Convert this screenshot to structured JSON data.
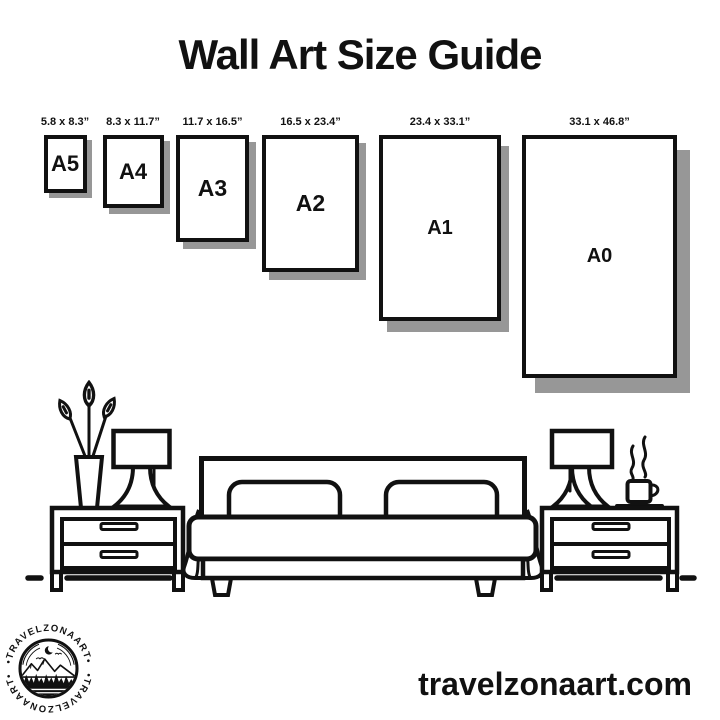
{
  "title": "Wall Art Size Guide",
  "sizes": [
    {
      "name": "A5",
      "dimensions": "5.8 x 8.3”"
    },
    {
      "name": "A4",
      "dimensions": "8.3 x 11.7”"
    },
    {
      "name": "A3",
      "dimensions": "11.7 x 16.5”"
    },
    {
      "name": "A2",
      "dimensions": "16.5 x 23.4”"
    },
    {
      "name": "A1",
      "dimensions": "23.4 x 33.1”"
    },
    {
      "name": "A0",
      "dimensions": "33.1 x 46.8”"
    }
  ],
  "illustration": {
    "icons": [
      "flower-vase-icon",
      "table-lamp-icon",
      "nightstand-icon",
      "double-bed-icon",
      "pillow-icon",
      "coffee-cup-icon",
      "steam-icon",
      "floor-line"
    ]
  },
  "logo": {
    "arc_text_top": "•TRAVELZONAART•",
    "arc_text_bottom": "•TRAVELZONAART•",
    "scene_icons": [
      "crescent-moon-icon",
      "rainbow-arc-icon",
      "birds-icon",
      "mountains-icon",
      "pine-trees-icon",
      "water-icon"
    ]
  },
  "footer": {
    "website": "travelzonaart.com"
  },
  "colors": {
    "ink": "#111111",
    "paper_shadow": "#979797",
    "background": "#ffffff"
  }
}
